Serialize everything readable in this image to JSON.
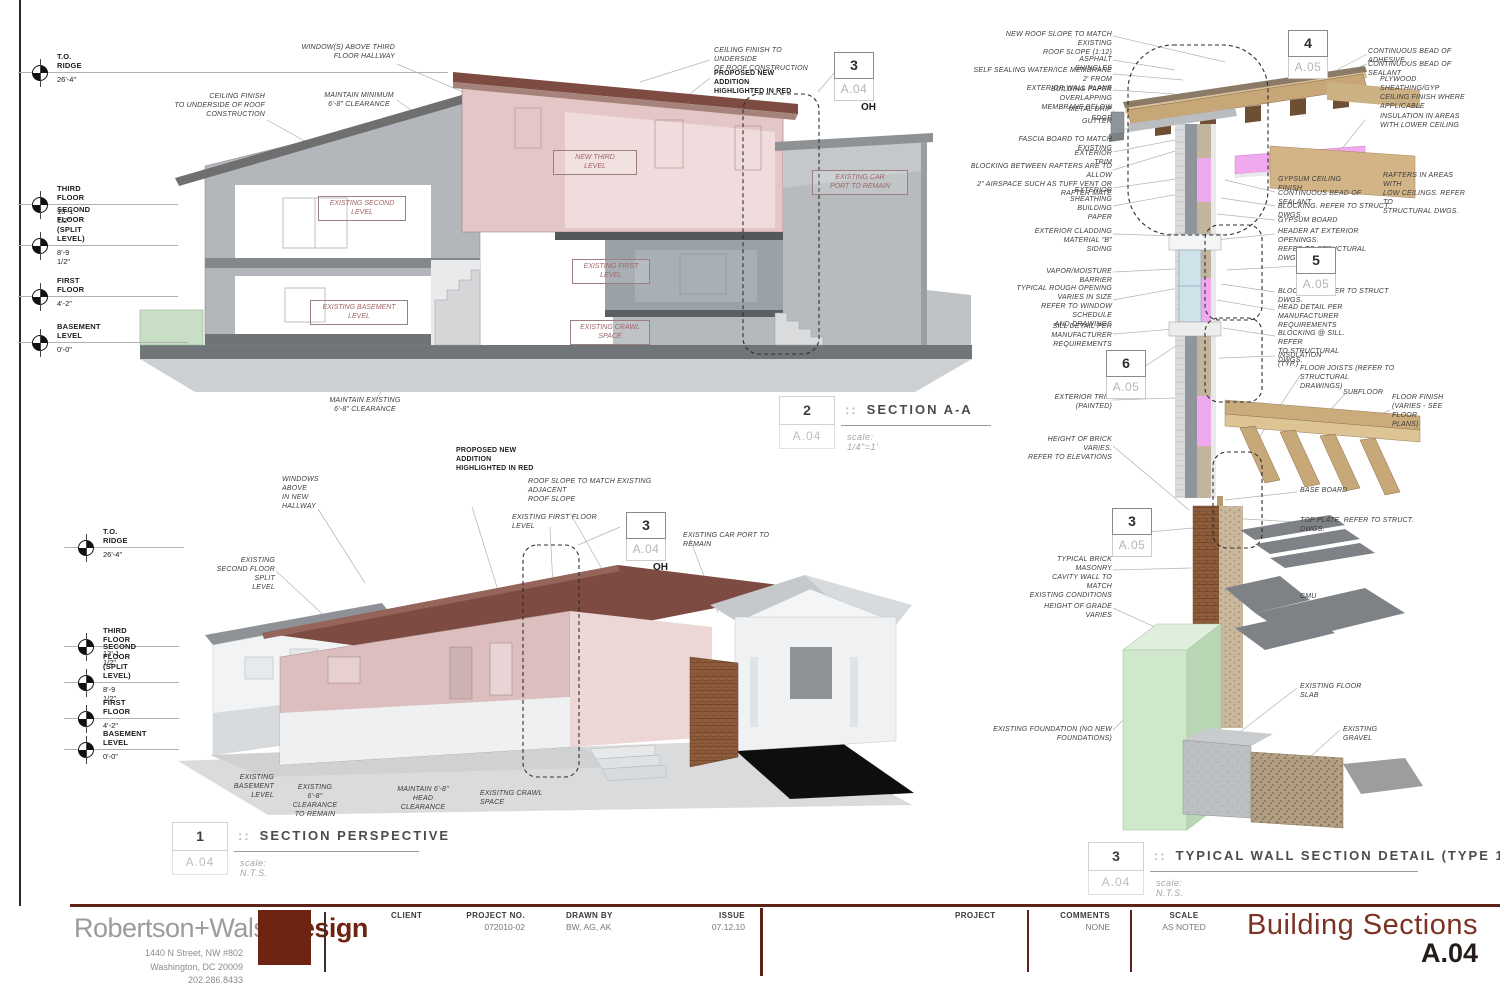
{
  "sheet": {
    "brand": {
      "name_gray": "Robertson+Walsh",
      "name_red": "Design",
      "address1": "1440 N Street, NW #802",
      "address2": "Washington, DC 20009",
      "phone": "202.286.8433"
    },
    "fields": {
      "client_label": "CLIENT",
      "project_no_label": "PROJECT NO.",
      "project_no": "072010-02",
      "drawn_by_label": "DRAWN BY",
      "drawn_by": "BW, AG, AK",
      "issue_label": "ISSUE",
      "issue": "07.12.10",
      "project_label": "PROJECT",
      "comments_label": "COMMENTS",
      "comments": "NONE",
      "scale_label": "SCALE",
      "scale": "AS NOTED"
    },
    "title": "Building Sections",
    "number": "A.04",
    "accent_color": "#6e2413",
    "highlight_color": "#e5c6c6"
  },
  "view_titles": [
    {
      "num": "2",
      "sep": "::",
      "name": "SECTION A-A",
      "sheet": "A.04",
      "scale": "scale: 1/4\"=1'"
    },
    {
      "num": "1",
      "sep": "::",
      "name": "SECTION PERSPECTIVE",
      "sheet": "A.04",
      "scale": "scale: N.T.S."
    },
    {
      "num": "3",
      "sep": "::",
      "name": "TYPICAL WALL SECTION DETAIL (TYPE 1)",
      "sheet": "A.04",
      "scale": "scale: N.T.S."
    }
  ],
  "levels": [
    {
      "x": 40,
      "y": 73,
      "l": "T.O. RIDGE",
      "e": "26'-4\"",
      "lw": 430
    },
    {
      "x": 40,
      "y": 205,
      "l": "THIRD FLOOR",
      "e": "13'-1 1/2\"",
      "lw": 160
    },
    {
      "x": 40,
      "y": 246,
      "l": "SECOND FLOOR\n(SPLIT LEVEL)",
      "e": "8'-9 1/2\"",
      "lw": 160
    },
    {
      "x": 40,
      "y": 297,
      "l": "FIRST FLOOR",
      "e": "4'-2\"",
      "lw": 160
    },
    {
      "x": 40,
      "y": 343,
      "l": "BASEMENT LEVEL",
      "e": "0'-0\"",
      "lw": 170
    },
    {
      "x": 86,
      "y": 548,
      "l": "T.O. RIDGE",
      "e": "26'-4\"",
      "lw": 120
    },
    {
      "x": 86,
      "y": 647,
      "l": "THIRD FLOOR",
      "e": "13'-1 1/2\"",
      "lw": 115
    },
    {
      "x": 86,
      "y": 683,
      "l": "SECOND FLOOR\n(SPLIT LEVEL)",
      "e": "8'-9 1/2\"",
      "lw": 115
    },
    {
      "x": 86,
      "y": 719,
      "l": "FIRST FLOOR",
      "e": "4'-2\"",
      "lw": 115
    },
    {
      "x": 86,
      "y": 750,
      "l": "BASEMENT LEVEL",
      "e": "0'-0\"",
      "lw": 115
    }
  ],
  "markers": [
    {
      "num": "3",
      "sheet": "A.04",
      "sub": "OH",
      "x": 834,
      "y": 52
    },
    {
      "num": "3",
      "sheet": "A.04",
      "sub": "OH",
      "x": 626,
      "y": 512
    },
    {
      "num": "4",
      "sheet": "A.05",
      "x": 1288,
      "y": 30
    },
    {
      "num": "5",
      "sheet": "A.05",
      "x": 1296,
      "y": 247
    },
    {
      "num": "6",
      "sheet": "A.05",
      "x": 1106,
      "y": 350
    },
    {
      "num": "3",
      "sheet": "A.05",
      "x": 1112,
      "y": 508
    }
  ],
  "room_labels": [
    {
      "t": "NEW THIRD\nLEVEL",
      "x": 553,
      "y": 150,
      "w": 76
    },
    {
      "t": "EXISTING SECOND\nLEVEL",
      "x": 318,
      "y": 196,
      "w": 80
    },
    {
      "t": "EXISTING FIRST\nLEVEL",
      "x": 572,
      "y": 259,
      "w": 70
    },
    {
      "t": "EXISTING BASEMENT\nLEVEL",
      "x": 310,
      "y": 300,
      "w": 90
    },
    {
      "t": "EXISTING CRAWL\nSPACE",
      "x": 570,
      "y": 320,
      "w": 72
    },
    {
      "t": "EXISTING CAR\nPORT TO REMAIN",
      "x": 812,
      "y": 170,
      "w": 88
    }
  ],
  "callouts": [
    {
      "t": "WINDOW(S) ABOVE THIRD\nFLOOR HALLWAY",
      "x": 300,
      "y": 43,
      "w": 95,
      "a": "r"
    },
    {
      "t": "CEILING FINISH\nTO UNDERSIDE OF ROOF\nCONSTRUCTION",
      "x": 173,
      "y": 92,
      "w": 92,
      "a": "r"
    },
    {
      "t": "MAINTAIN MINIMUM\n6'-8\" CLEARANCE",
      "x": 320,
      "y": 91,
      "w": 78,
      "a": "c"
    },
    {
      "t": "CEILING FINISH TO UNDERSIDE\nOF ROOF CONSTRUCTION",
      "x": 714,
      "y": 46,
      "w": 100,
      "a": "l"
    },
    {
      "t": "PROPOSED NEW ADDITION\nHIGHLIGHTED IN RED",
      "x": 714,
      "y": 69,
      "w": 92,
      "a": "l",
      "b": true
    },
    {
      "t": "MAINTAIN EXISTING\n6'-8\" CLEARANCE",
      "x": 328,
      "y": 396,
      "w": 74,
      "a": "c"
    },
    {
      "t": "WINDOWS ABOVE\nIN NEW HALLWAY",
      "x": 282,
      "y": 475,
      "w": 62,
      "a": "l"
    },
    {
      "t": "PROPOSED NEW ADDITION\nHIGHLIGHTED IN RED",
      "x": 456,
      "y": 446,
      "w": 92,
      "a": "l",
      "b": true
    },
    {
      "t": "ROOF SLOPE TO MATCH EXISTING ADJACENT\nROOF SLOPE",
      "x": 528,
      "y": 477,
      "w": 140,
      "a": "l"
    },
    {
      "t": "EXISTING FIRST FLOOR LEVEL",
      "x": 512,
      "y": 513,
      "w": 92,
      "a": "l"
    },
    {
      "t": "EXISTING CAR PORT TO REMAIN",
      "x": 683,
      "y": 531,
      "w": 98,
      "a": "l"
    },
    {
      "t": "EXISTING\nSECOND FLOOR SPLIT\nLEVEL",
      "x": 203,
      "y": 556,
      "w": 72,
      "a": "r"
    },
    {
      "t": "EXISTING BASEMENT\nLEVEL",
      "x": 208,
      "y": 773,
      "w": 66,
      "a": "r"
    },
    {
      "t": "EXISTING 6'-8\"\nCLEARANCE\nTO REMAIN",
      "x": 292,
      "y": 783,
      "w": 46,
      "a": "c"
    },
    {
      "t": "MAINTAIN 6'-8\"\nHEAD CLEARANCE",
      "x": 393,
      "y": 785,
      "w": 60,
      "a": "c"
    },
    {
      "t": "EXISITNG CRAWL SPACE",
      "x": 480,
      "y": 789,
      "w": 76,
      "a": "l"
    },
    {
      "t": "NEW ROOF SLOPE TO MATCH EXISTING\nROOF SLOPE (1:12)",
      "x": 992,
      "y": 30,
      "w": 120,
      "a": "r"
    },
    {
      "t": "ASPHALT SHINGLES",
      "x": 1042,
      "y": 55,
      "w": 70,
      "a": "r"
    },
    {
      "t": "SELF SEALING WATER/ICE MEMBRANE 2' FROM\nEXTERIOR WALL PLANE",
      "x": 970,
      "y": 66,
      "w": 142,
      "a": "r"
    },
    {
      "t": "BUILDING PAPER OVERLAPPING\nMEMBRANE BELOW",
      "x": 1010,
      "y": 85,
      "w": 102,
      "a": "r"
    },
    {
      "t": "METAL DRIP EDGE",
      "x": 1052,
      "y": 105,
      "w": 60,
      "a": "r"
    },
    {
      "t": "GUTTER",
      "x": 1070,
      "y": 117,
      "w": 42,
      "a": "r"
    },
    {
      "t": "FASCIA BOARD TO MATCH EXISTING",
      "x": 1000,
      "y": 135,
      "w": 112,
      "a": "r"
    },
    {
      "t": "EXTERIOR TRIM",
      "x": 1058,
      "y": 149,
      "w": 54,
      "a": "r"
    },
    {
      "t": "BLOCKING BETWEEN RAFTERS ARE TO ALLOW\n2\" AIRSPACE SUCH AS TUFF VENT OR RAFTER MATE",
      "x": 962,
      "y": 162,
      "w": 150,
      "a": "r"
    },
    {
      "t": "EXTERIOR SHEATHING",
      "x": 1040,
      "y": 186,
      "w": 72,
      "a": "r"
    },
    {
      "t": "BUILDING PAPER",
      "x": 1056,
      "y": 204,
      "w": 56,
      "a": "r"
    },
    {
      "t": "EXTERIOR CLADDING MATERIAL \"B\"\nSIDING",
      "x": 1000,
      "y": 227,
      "w": 112,
      "a": "r"
    },
    {
      "t": "VAPOR/MOISTURE BARRIER",
      "x": 1024,
      "y": 267,
      "w": 88,
      "a": "r"
    },
    {
      "t": "TYPICAL ROUGH OPENING\nVARIES IN SIZE\nREFER TO WINDOW SCHEDULE\nAND DRAWINGS",
      "x": 1010,
      "y": 284,
      "w": 102,
      "a": "r"
    },
    {
      "t": "SILL DETAIL PER\nMANUFACTURER\nREQUIREMENTS",
      "x": 1048,
      "y": 322,
      "w": 64,
      "a": "r"
    },
    {
      "t": "EXTERIOR TRIM (PAINTED)",
      "x": 1026,
      "y": 393,
      "w": 86,
      "a": "r"
    },
    {
      "t": "HEIGHT OF BRICK VARIES.\nREFER TO ELEVATIONS",
      "x": 1026,
      "y": 435,
      "w": 86,
      "a": "r"
    },
    {
      "t": "TYPICAL BRICK MASONRY\nCAVITY WALL TO MATCH\nEXISTING CONDITIONS",
      "x": 1026,
      "y": 555,
      "w": 86,
      "a": "r"
    },
    {
      "t": "HEIGHT OF GRADE VARIES",
      "x": 1024,
      "y": 602,
      "w": 88,
      "a": "r"
    },
    {
      "t": "EXISTING FOUNDATION (NO NEW FOUNDATIONS)",
      "x": 962,
      "y": 725,
      "w": 150,
      "a": "r"
    },
    {
      "t": "CONTINUOUS BEAD OF ADHESIVE",
      "x": 1368,
      "y": 47,
      "w": 108,
      "a": "l"
    },
    {
      "t": "CONTINUOUS BEAD OF SEALANT",
      "x": 1368,
      "y": 60,
      "w": 108,
      "a": "l"
    },
    {
      "t": "PLYWOOD SHEATHING/GYP\nCEILING FINISH WHERE\nAPPLICABLE",
      "x": 1380,
      "y": 75,
      "w": 92,
      "a": "l"
    },
    {
      "t": "INSULATION IN AREAS\nWITH LOWER CEILING",
      "x": 1380,
      "y": 112,
      "w": 82,
      "a": "l"
    },
    {
      "t": "GYPSUM CEILING FINISH",
      "x": 1278,
      "y": 175,
      "w": 82,
      "a": "l"
    },
    {
      "t": "RAFTERS IN AREAS WITH\nLOW CEILINGS. REFER TO\nSTRUCTURAL DWGS.",
      "x": 1383,
      "y": 171,
      "w": 86,
      "a": "l"
    },
    {
      "t": "CONTINUOUS BEAD OF SEALANT",
      "x": 1278,
      "y": 189,
      "w": 102,
      "a": "l"
    },
    {
      "t": "BLOCKING. REFER TO STRUCT. DWGS.",
      "x": 1278,
      "y": 202,
      "w": 118,
      "a": "l"
    },
    {
      "t": "GYPSUM BOARD",
      "x": 1278,
      "y": 216,
      "w": 60,
      "a": "l"
    },
    {
      "t": "HEADER AT EXTERIOR OPENINGS.\nREFER TO STRUCTURAL DWGS.",
      "x": 1278,
      "y": 227,
      "w": 102,
      "a": "l"
    },
    {
      "t": "BLOCKING. REFER TO STRUCT DWGS.",
      "x": 1278,
      "y": 287,
      "w": 118,
      "a": "l"
    },
    {
      "t": "HEAD DETAIL PER MANUFACTURER\nREQUIREMENTS",
      "x": 1278,
      "y": 303,
      "w": 108,
      "a": "l"
    },
    {
      "t": "BLOCKING @ SILL. REFER\nTO STRUCTURAL DWGS.",
      "x": 1278,
      "y": 329,
      "w": 82,
      "a": "l"
    },
    {
      "t": "INSULATION (TYP.)",
      "x": 1278,
      "y": 351,
      "w": 64,
      "a": "l"
    },
    {
      "t": "FLOOR JOISTS (REFER TO STRUCTURAL\nDRAWINGS)",
      "x": 1300,
      "y": 364,
      "w": 122,
      "a": "l"
    },
    {
      "t": "SUBFLOOR",
      "x": 1343,
      "y": 388,
      "w": 42,
      "a": "l"
    },
    {
      "t": "FLOOR FINISH\n(VARIES - SEE FLOOR\nPLANS)",
      "x": 1392,
      "y": 393,
      "w": 72,
      "a": "l"
    },
    {
      "t": "BASE BOARD",
      "x": 1300,
      "y": 486,
      "w": 48,
      "a": "l"
    },
    {
      "t": "TOP PLATE. REFER TO STRUCT. DWGS.",
      "x": 1300,
      "y": 516,
      "w": 118,
      "a": "l"
    },
    {
      "t": "CMU",
      "x": 1300,
      "y": 592,
      "w": 26,
      "a": "l"
    },
    {
      "t": "EXISTING FLOOR SLAB",
      "x": 1300,
      "y": 682,
      "w": 74,
      "a": "l"
    },
    {
      "t": "EXISTING GRAVEL",
      "x": 1343,
      "y": 725,
      "w": 64,
      "a": "l"
    }
  ]
}
